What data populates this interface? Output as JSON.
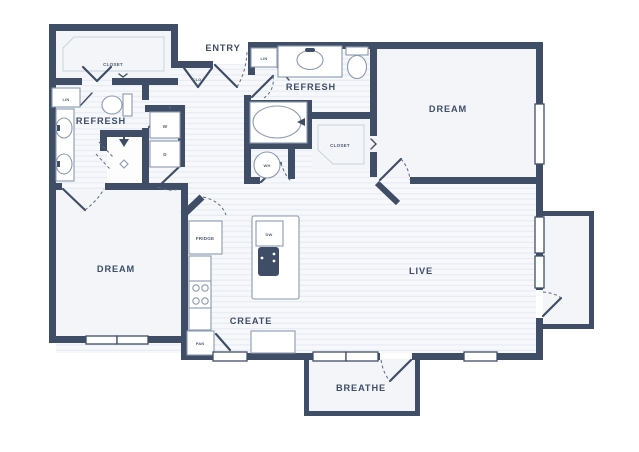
{
  "title": "Apartment floor plan",
  "colors": {
    "wall": "#3f4e66",
    "floor": "#f7f8fb",
    "hatch": "#e7ebf2",
    "room": "#f3f5f9",
    "outline": "#c9d3e0",
    "fixture": "#8b99b0",
    "label": "#3e4d68",
    "fixture_label": "#4d5d78",
    "bg": "#ffffff",
    "arc": "#5a6a84"
  },
  "rooms": {
    "entry": {
      "label": "ENTRY"
    },
    "refresh_master": {
      "label": "REFRESH"
    },
    "refresh_guest": {
      "label": "REFRESH"
    },
    "dream_master": {
      "label": "DREAM"
    },
    "dream_guest": {
      "label": "DREAM"
    },
    "live": {
      "label": "LIVE"
    },
    "create": {
      "label": "CREATE"
    },
    "breathe": {
      "label": "BREATHE"
    },
    "closet_master": {
      "label": "CLOSET"
    },
    "closet_guest": {
      "label": "CLOSET"
    }
  },
  "fixtures": {
    "washer": {
      "label": "W"
    },
    "dryer": {
      "label": "D"
    },
    "water_heater": {
      "label": "WH"
    },
    "dishwasher": {
      "label": "DW"
    },
    "fridge": {
      "label": "FRIDGE"
    },
    "pantry": {
      "label": "PAN"
    },
    "linen_master": {
      "label": "LIN"
    },
    "linen_guest": {
      "label": "LIN"
    },
    "coat_closet": {
      "label": "CLO"
    }
  }
}
